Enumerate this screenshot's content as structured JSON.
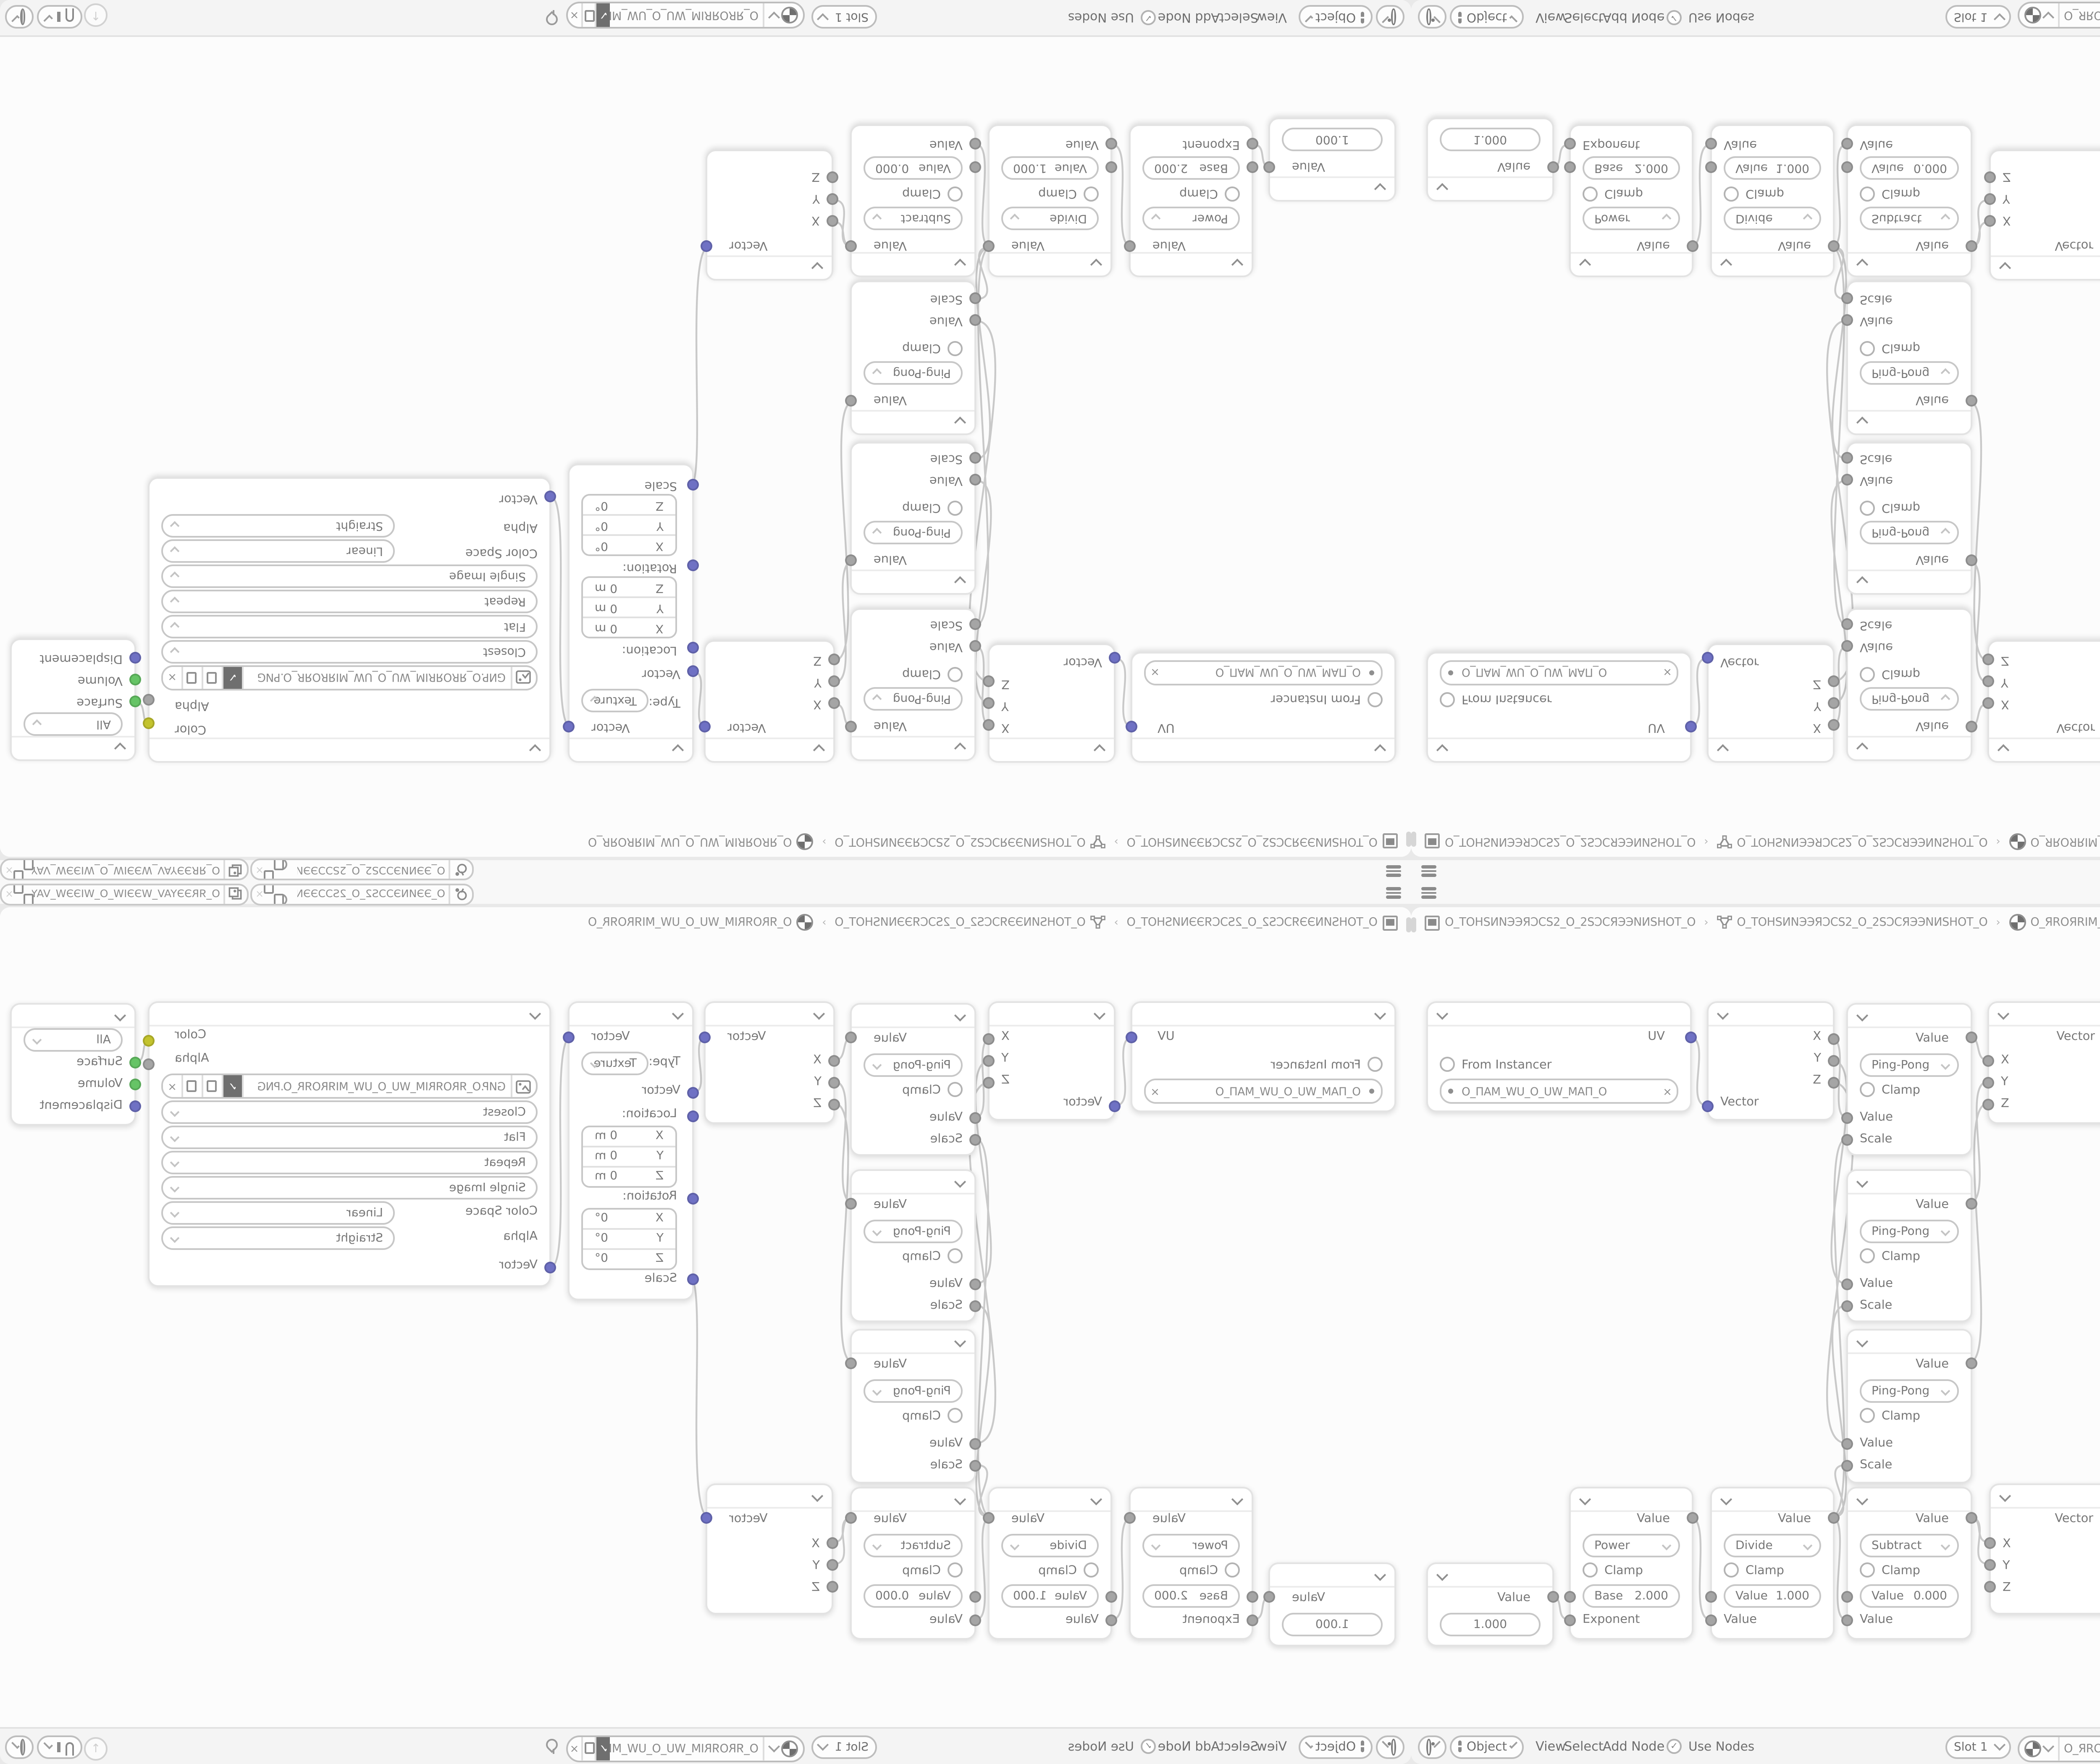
{
  "app_context": {
    "editor": "Shader Editor",
    "layout": "four-quadrant mirrored window"
  },
  "colors": {
    "vector_socket": "#6f71c4",
    "value_socket": "#a5a5a5",
    "color_socket": "#c3c32e",
    "shader_socket": "#66c466",
    "wire": "#c9c9c9",
    "node_bg": "#ffffff",
    "canvas_bg": "#fcfcfc",
    "header_bg": "#f4f4f4"
  },
  "topbar": {
    "scene_selector": "O_ЭЭИNЭƆƆS2_O_2SƆƆЭЭN...",
    "viewlayer_selector": "O_ЯRЭЭYAV_WЭЭIW_O_WIЭЭW_VAYЭЭRЯ_O",
    "close_label": "×"
  },
  "breadcrumb": {
    "scene": "O_TOHSИNЭЭЯƆCS2_O_2SƆCЯЭЭNИSHOT_O",
    "object": "O_TOHSИNЭЭЯƆCS2_O_2SƆCЯЭЭNИSHOT_O",
    "material": "O_ЯROЯRIM_WU_O_UW_MIЯROЯR_O",
    "separator": "›"
  },
  "header": {
    "mode": "Object",
    "menus": [
      "View",
      "Select",
      "Add",
      "Node"
    ],
    "use_nodes": "Use Nodes",
    "use_nodes_check": "✓",
    "slot": "Slot 1",
    "material": "O_ЯROЯRIM_WU_O_UW_MIЯROЯR_O",
    "shield_glyph": "✓",
    "close_glyph": "×",
    "up_arrow": "↑"
  },
  "nodes": {
    "uv_map": {
      "output": "UV",
      "from_instancer": "From Instancer",
      "uv_map_name": "O_ПAM_WU_O_UW_MAП_O",
      "remove_glyph": "×"
    },
    "separate_xyz": {
      "out_x": "X",
      "out_y": "Y",
      "out_z": "Z",
      "input": "Vector"
    },
    "math_pingpong": {
      "output": "Value",
      "operation": "Ping-Pong",
      "clamp": "Clamp",
      "input_value": "Value",
      "input_scale": "Scale"
    },
    "combine_xyz": {
      "output": "Vector",
      "in_x": "X",
      "in_y": "Y",
      "in_z": "Z"
    },
    "mapping": {
      "output": "Vector",
      "type_label": "Type:",
      "type": "Texture",
      "input": "Vector",
      "location_label": "Location:",
      "rotation_label": "Rotation:",
      "scale_label": "Scale",
      "location": [
        [
          "X",
          "0 m"
        ],
        [
          "Y",
          "0 m"
        ],
        [
          "Z",
          "0 m"
        ]
      ],
      "rotation": [
        [
          "X",
          "0°"
        ],
        [
          "Y",
          "0°"
        ],
        [
          "Z",
          "0°"
        ]
      ]
    },
    "image_texture": {
      "output_color": "Color",
      "output_alpha": "Alpha",
      "filename": "GИP.O_ЯROЯRIM_WU_O_UW_MIЯROЯR_O.PNG",
      "interpolation": "Closest",
      "projection": "Flat",
      "extension": "Repeat",
      "source": "Single Image",
      "color_space_label": "Color Space",
      "color_space": "Linear",
      "alpha_label": "Alpha",
      "alpha_mode": "Straight",
      "input": "Vector",
      "remove_glyph": "×",
      "shield_glyph": "✓"
    },
    "material_output": {
      "target": "All",
      "in_surface": "Surface",
      "in_volume": "Volume",
      "in_displacement": "Displacement"
    },
    "value": {
      "output": "Value",
      "value": "1.000"
    },
    "math_power": {
      "output": "Value",
      "operation": "Power",
      "clamp": "Clamp",
      "field_label": "Base",
      "field_value": "2.000",
      "input": "Exponent"
    },
    "math_divide": {
      "output": "Value",
      "operation": "Divide",
      "clamp": "Clamp",
      "field_label": "Value",
      "field_value": "1.000",
      "input": "Value"
    },
    "math_subtract": {
      "output": "Value",
      "operation": "Subtract",
      "clamp": "Clamp",
      "field_label": "Value",
      "field_value": "0.000",
      "input": "Value"
    }
  }
}
